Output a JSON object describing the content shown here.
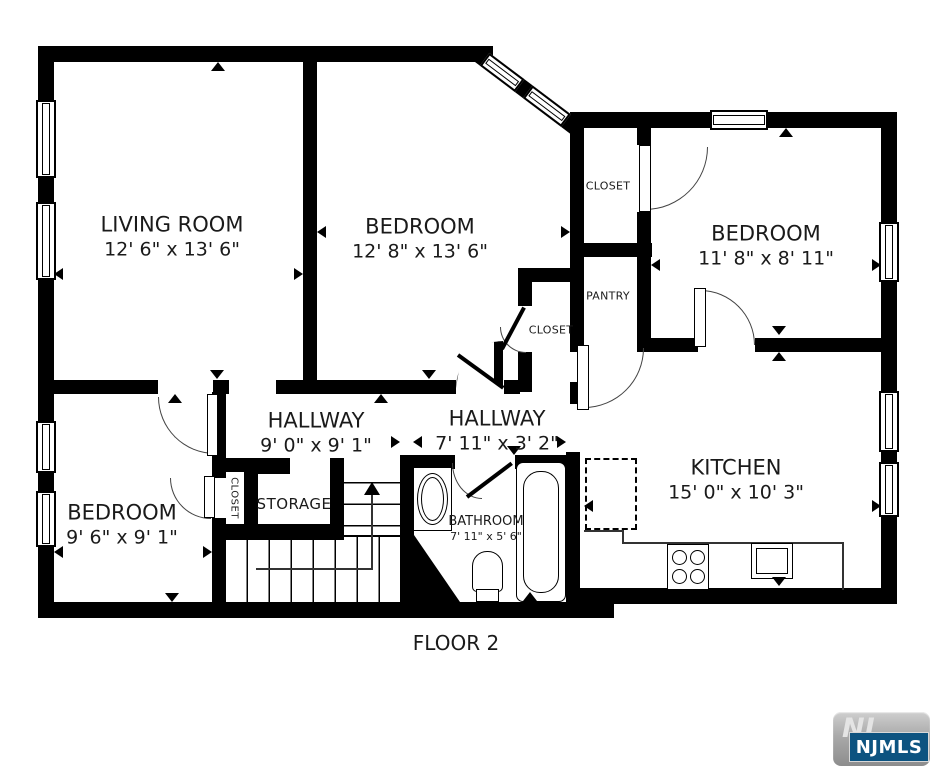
{
  "floor_plan": {
    "floor_label": "FLOOR 2",
    "rooms": [
      {
        "id": "living-room",
        "name": "LIVING ROOM",
        "dimensions": "12' 6\" x 13' 6\""
      },
      {
        "id": "bedroom-top",
        "name": "BEDROOM",
        "dimensions": "12' 8\" x 13' 6\""
      },
      {
        "id": "bedroom-right",
        "name": "BEDROOM",
        "dimensions": "11' 8\" x 8' 11\""
      },
      {
        "id": "bedroom-lower",
        "name": "BEDROOM",
        "dimensions": "9' 6\" x 9' 1\""
      },
      {
        "id": "hallway-west",
        "name": "HALLWAY",
        "dimensions": "9' 0\" x 9' 1\""
      },
      {
        "id": "hallway-east",
        "name": "HALLWAY",
        "dimensions": "7' 11\" x 3' 2\""
      },
      {
        "id": "kitchen",
        "name": "KITCHEN",
        "dimensions": "15' 0\" x 10' 3\""
      },
      {
        "id": "bathroom",
        "name": "BATHROOM",
        "dimensions": "7' 11\" x 5' 6\""
      },
      {
        "id": "closet-upper-right",
        "name": "CLOSET"
      },
      {
        "id": "pantry",
        "name": "PANTRY"
      },
      {
        "id": "closet-mid",
        "name": "CLOSET"
      },
      {
        "id": "closet-lower-left",
        "name": "CLOSET"
      },
      {
        "id": "storage",
        "name": "STORAGE"
      }
    ],
    "fixtures": [
      "staircase-up",
      "bathtub",
      "toilet",
      "bathroom-sink",
      "stove",
      "kitchen-sink",
      "dashed-appliance"
    ],
    "watermark": {
      "monogram": "NJ",
      "label": "NJMLS"
    },
    "colors": {
      "walls": "#000000",
      "background": "#ffffff",
      "door_arc": "#444444",
      "logo_blue": "#0d5380",
      "logo_gray": "#a9a9a9"
    }
  }
}
